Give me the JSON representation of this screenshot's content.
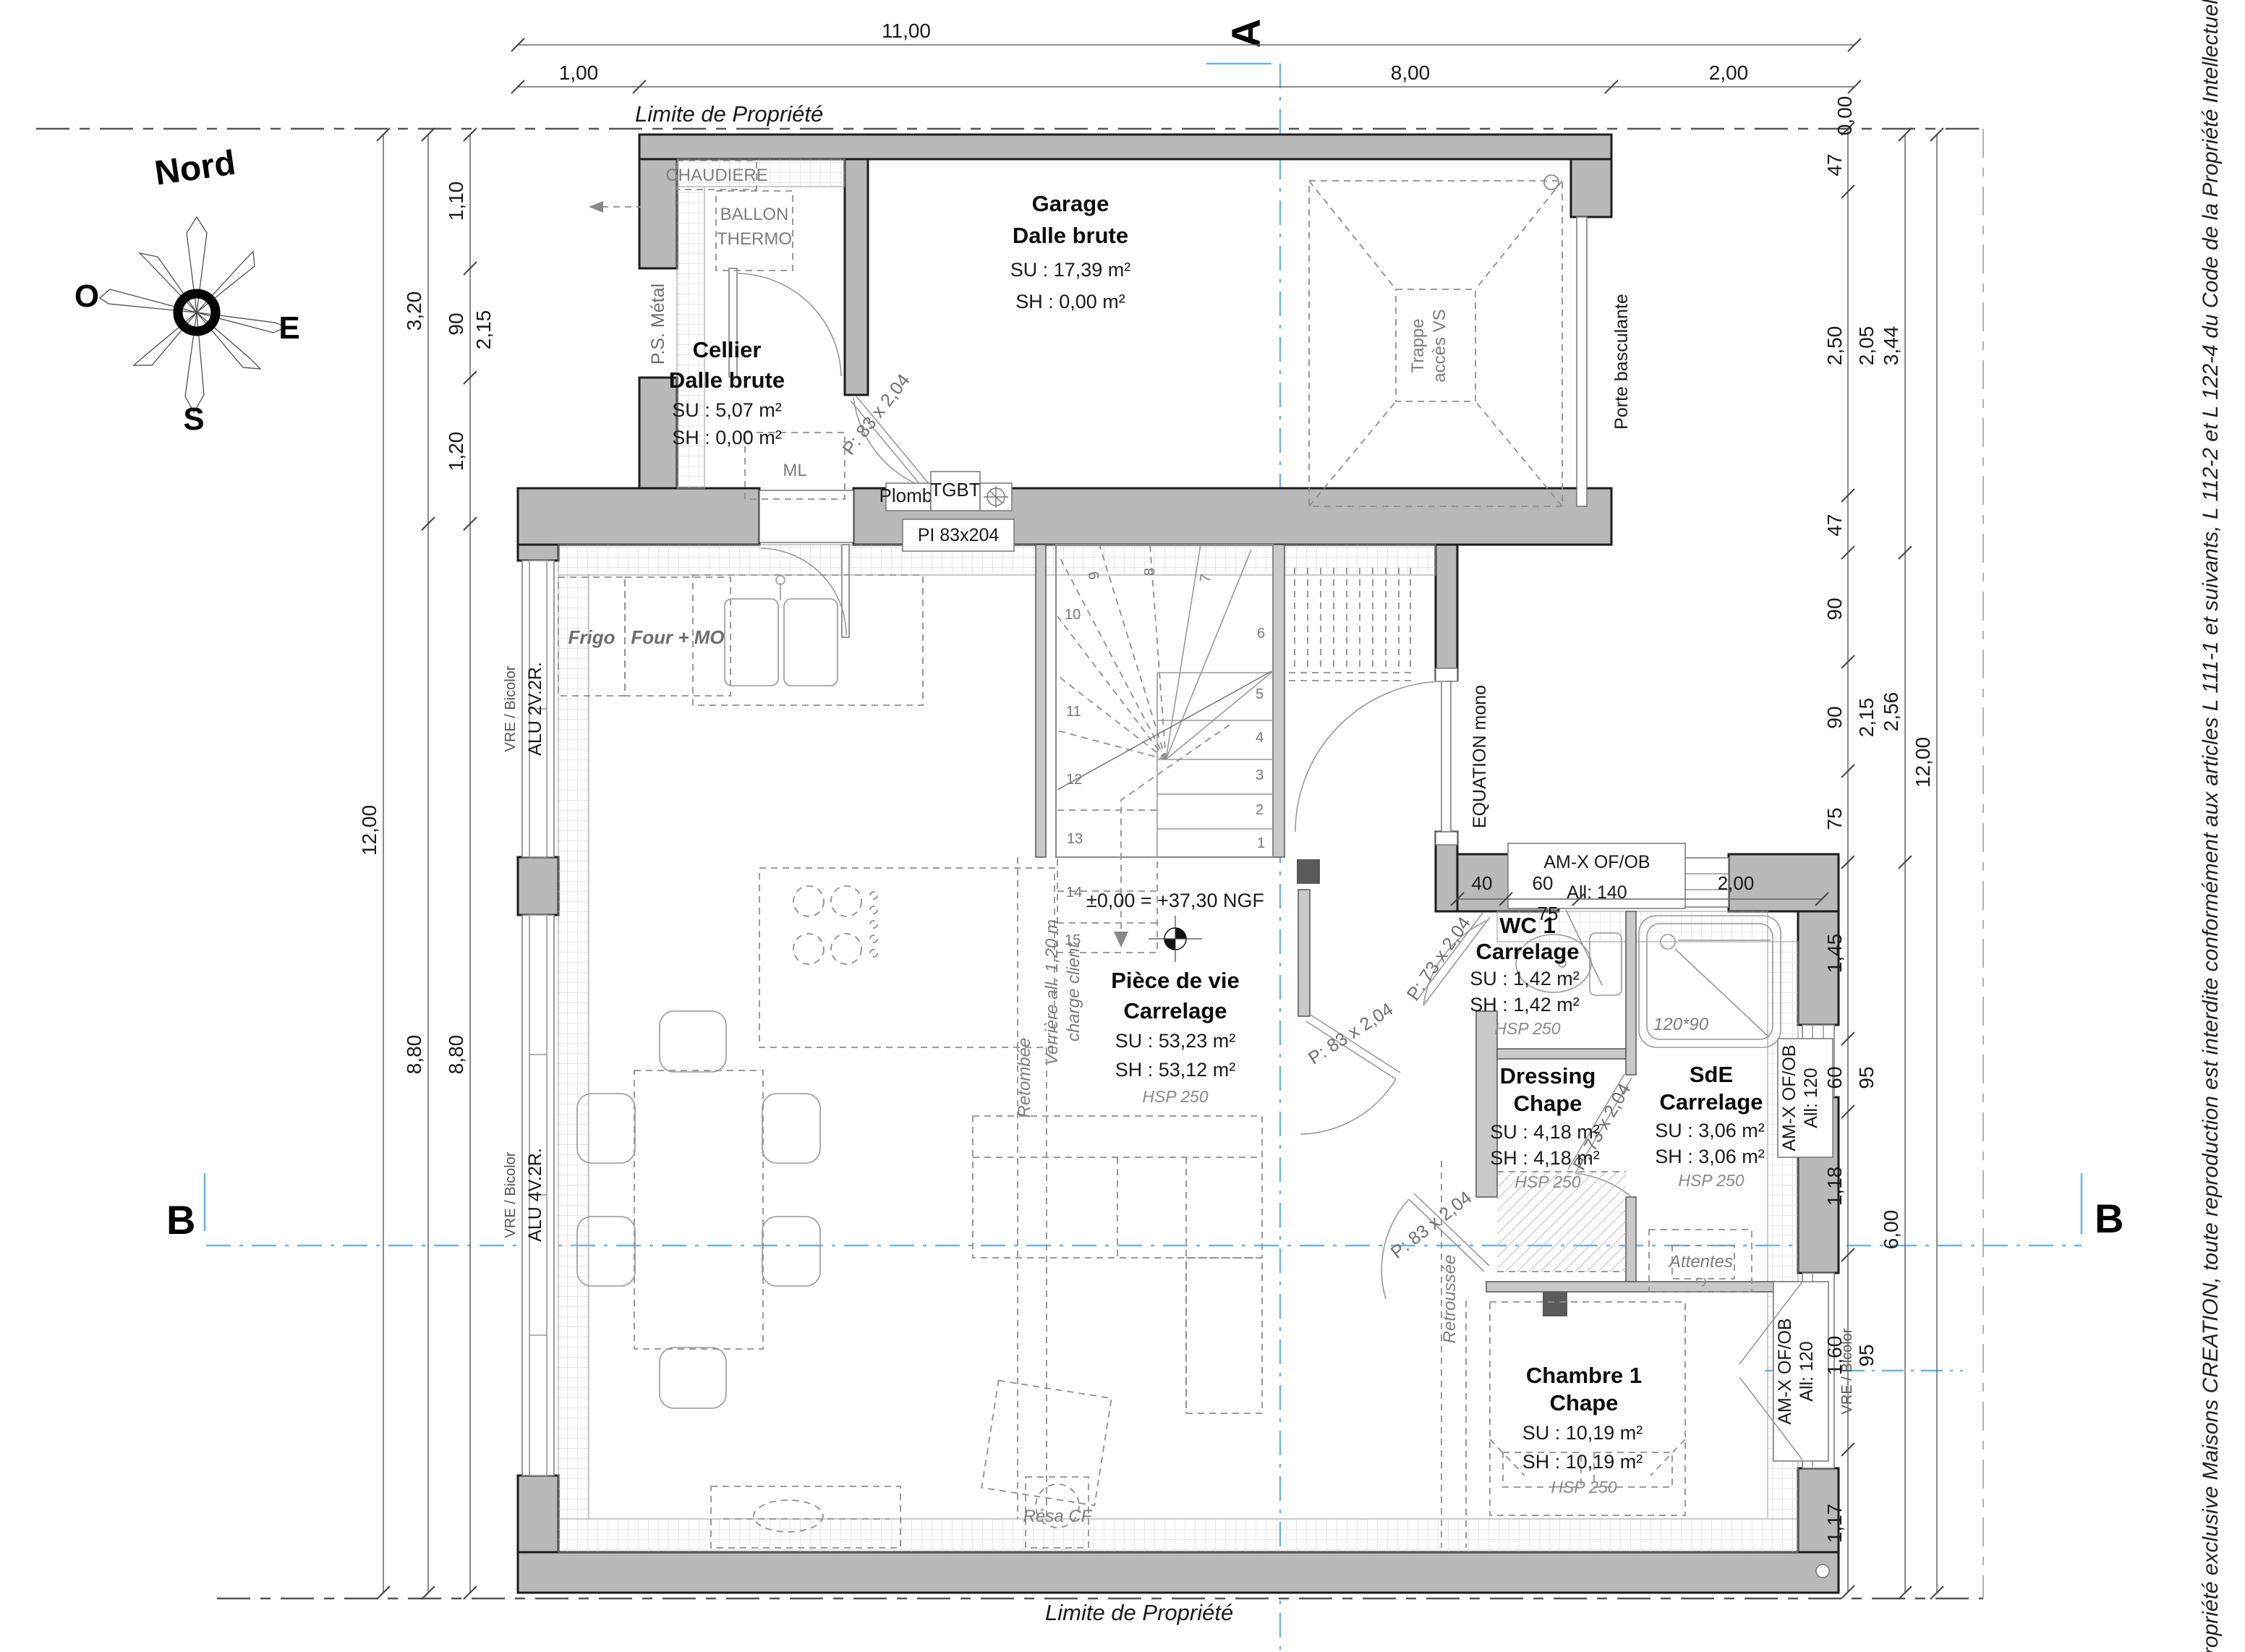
{
  "property": {
    "top": "Limite de Propriété",
    "bottom": "Limite de Propriété"
  },
  "compass": {
    "n": "Nord",
    "w": "O",
    "e": "E",
    "s": "S"
  },
  "sections": {
    "a": "A",
    "b": "B"
  },
  "copyright": "Propriété exclusive Maisons CREATION, toute reproduction est interdite conformément aux articles L 111-1 et suivants, L 112-2 et L 122-4 du Code de la Propriété Intellectuelle",
  "levels": {
    "ngf": "±0,00 = +37,30 NGF"
  },
  "rooms": {
    "garage": {
      "name": "Garage",
      "floor": "Dalle brute",
      "su": "SU : 17,39 m²",
      "sh": "SH : 0,00 m²"
    },
    "cellier": {
      "name": "Cellier",
      "floor": "Dalle brute",
      "su": "SU : 5,07 m²",
      "sh": "SH : 0,00 m²"
    },
    "piece": {
      "name": "Pièce de vie",
      "floor": "Carrelage",
      "su": "SU : 53,23 m²",
      "sh": "SH : 53,12 m²",
      "hsp": "HSP 250"
    },
    "wc1": {
      "name": "WC 1",
      "floor": "Carrelage",
      "su": "SU : 1,42 m²",
      "sh": "SH : 1,42 m²",
      "hsp": "HSP 250"
    },
    "dressing": {
      "name": "Dressing",
      "floor": "Chape",
      "su": "SU : 4,18 m²",
      "sh": "SH : 4,18 m²",
      "hsp": "HSP 250"
    },
    "sde": {
      "name": "SdE",
      "floor": "Carrelage",
      "su": "SU : 3,06 m²",
      "sh": "SH : 3,06 m²",
      "hsp": "HSP 250"
    },
    "chambre1": {
      "name": "Chambre 1",
      "floor": "Chape",
      "su": "SU : 10,19 m²",
      "sh": "SH : 10,19 m²",
      "hsp": "HSP 250"
    }
  },
  "equipment": {
    "chaudiere": "CHAUDIERE",
    "ballon1": "BALLON",
    "ballon2": "THERMO",
    "ps_metal": "P.S. Métal",
    "ml": "ML",
    "frigo": "Frigo",
    "four_mo": "Four + MO",
    "plomb": "Plomb.",
    "tgbt": "TGBT",
    "pi": "PI 83x204",
    "trappe1": "Trappe",
    "trappe2": "accès VS",
    "porte_basculante": "Porte basculante",
    "equation": "EQUATION mono",
    "verriere1": "Verrière all. 1,20 m",
    "verriere2": "charge client",
    "retombee": "Retombée",
    "retroussee": "Retroussée",
    "resa_cf": "Résa CF",
    "attentes": "Attentes",
    "shower_size": "120*90"
  },
  "doors": {
    "d83": "P: 83 x 2,04",
    "d73": "P: 73 x 2,04"
  },
  "windows": {
    "amx": "AM-X OF/OB",
    "all140": "All:  140",
    "all120": "All:  120",
    "vre": "VRE / Bicolor",
    "alu2v": "ALU 2V.2R.",
    "alu4v": "ALU 4V.2R."
  },
  "stairs": {
    "numbers": [
      "1",
      "2",
      "3",
      "4",
      "5",
      "6",
      "7",
      "8",
      "9",
      "10",
      "11",
      "12",
      "13",
      "14",
      "15"
    ]
  },
  "dims": {
    "top": {
      "total": "11,00",
      "a": "1,00",
      "b": "8,00",
      "c": "2,00"
    },
    "left": {
      "total": "12,00",
      "a": "3,20",
      "b": "8,80",
      "c": "1,10",
      "d": "90",
      "e": "2,15",
      "f": "1,20",
      "g": "8,80"
    },
    "right": {
      "zero": "0,00",
      "a": "47",
      "b": "2,50",
      "b2": "2,05",
      "tot1": "3,44",
      "c": "47",
      "d": "90",
      "e": "90",
      "e2": "2,15",
      "tot2": "2,56",
      "f": "75",
      "g": "1,45",
      "h": "60",
      "h2": "95",
      "i": "1,18",
      "tot3": "12,00",
      "j": "1,60",
      "j2": "95",
      "tot4": "6,00",
      "k": "1,17"
    },
    "porch": {
      "a": "40",
      "b": "60",
      "c": "75",
      "d": "2,00"
    }
  }
}
